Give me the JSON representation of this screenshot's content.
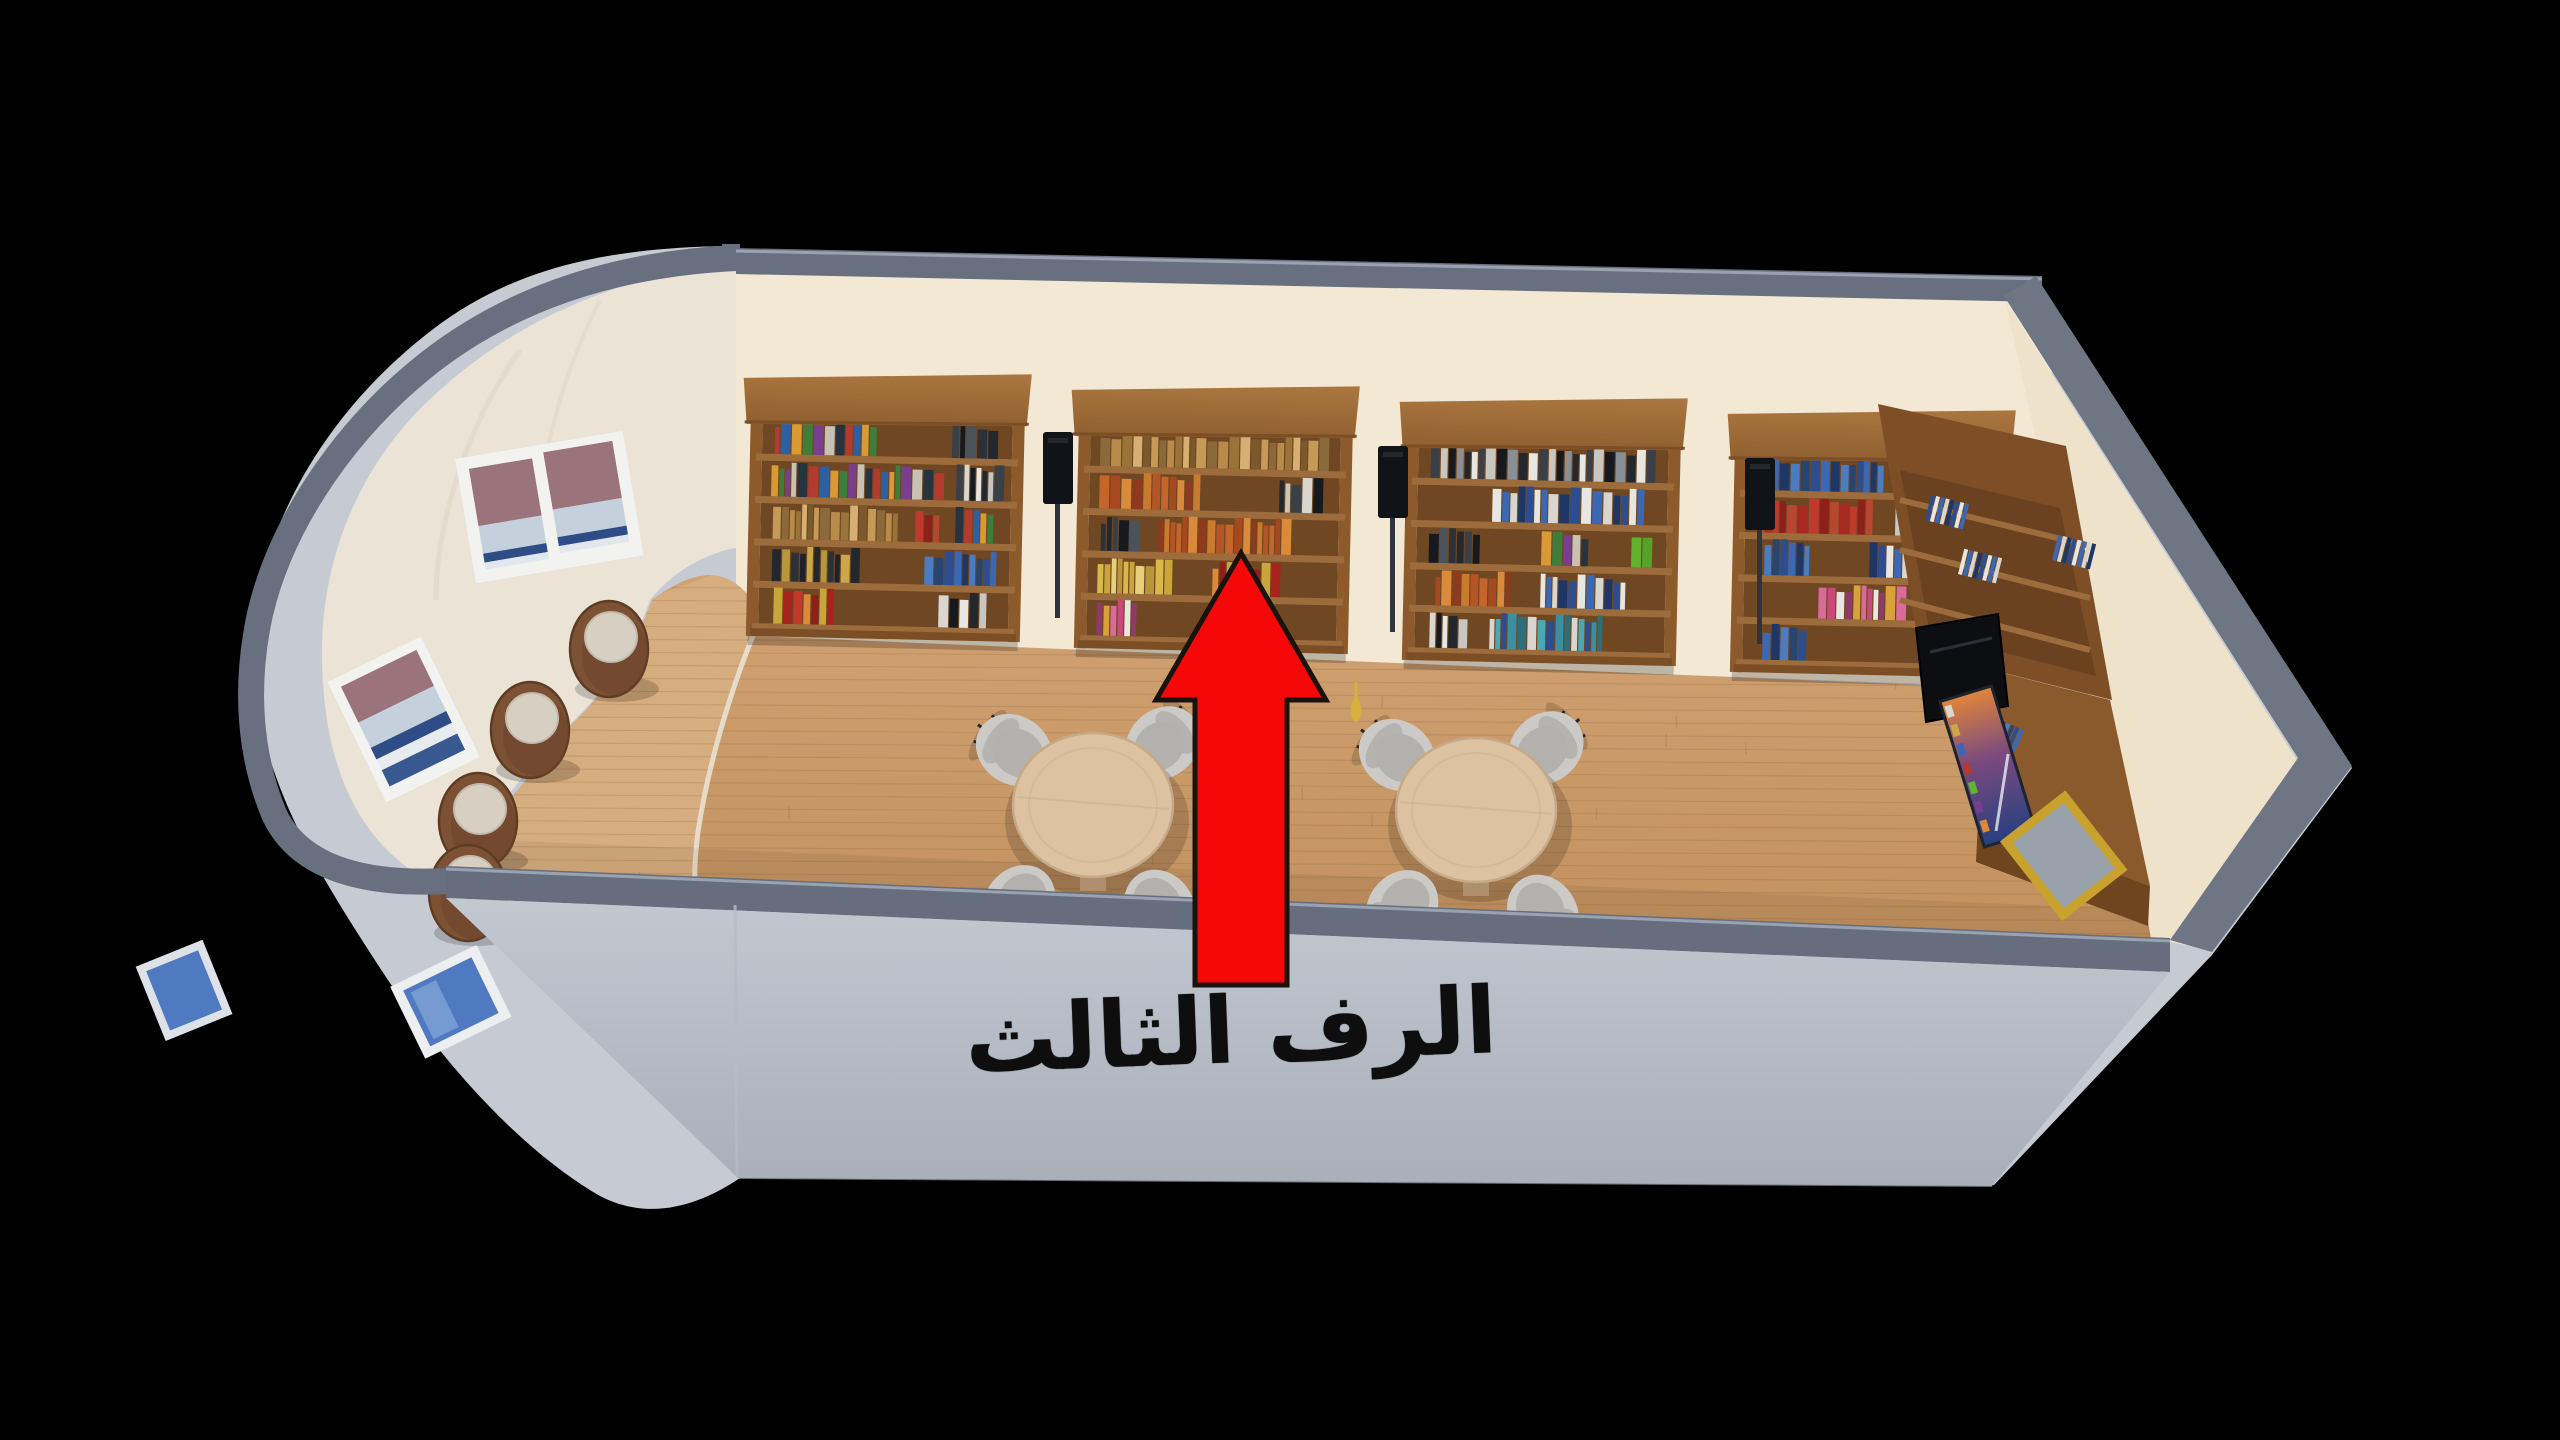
{
  "annotation": {
    "label": "الرف الثالث",
    "meaning": "points to the third shelf of the middle bookcase",
    "text_color": "#0e0e0e",
    "arrow_icon": "up-arrow-icon",
    "arrow_color": "#f70808",
    "arrow_outline": "#1a120c"
  },
  "room": {
    "background": "#000000",
    "wall_top_band": "#68707f",
    "wall_band_lip": "#99a2b0",
    "exterior_wall": "#c6cbd3",
    "front_wall_top": "#c2c8d0",
    "front_wall_bottom": "#a9afb9",
    "back_wall": "#f2e8d4",
    "curved_wall": "#eae3d6",
    "right_wall": "#efe2cb",
    "floor": "#cb9b68",
    "floor_light": "#d6ad7e",
    "floor_line": "#e9e2d4",
    "shelf_wood": "#8c5a2b",
    "shelf_cap": "#a06c38",
    "shelf_interior": "#6f4722",
    "shelf_board": "#9c6c3c",
    "shelf_plinth": "#7b4e26",
    "table_top": "#dcc2a0",
    "table_rim": "#c6a987",
    "table_base": "#b08f6f",
    "chair_shell": "#cbcac6",
    "chair_seat": "#b2b1ad",
    "chair_leg": "#26262a",
    "stool_body": "#7c5134",
    "stool_rim": "#5e3c24",
    "stool_cushion": "#d7cfc2",
    "speaker": "#101317",
    "tv_screen": "#0c0e11",
    "window_frame": "#f2f2f0",
    "glass_blue": "#4f79c0",
    "glass_blue_light": "#7fa3d6",
    "glass_mauve": "#9b737b",
    "glass_sky": "#c5d0dd",
    "glass_navy": "#2e4d86",
    "poster_gold_frame": "#c9a22e",
    "tassel_gold": "#d8b13a"
  },
  "furniture": {
    "bookshelf_units": 4,
    "shelf_rows_per_unit": 5,
    "round_tables": 2,
    "chairs_per_table": 4,
    "barrel_stools": 4,
    "floor_speakers": 3,
    "tv_screens": 1,
    "curved_wall_windows": 2,
    "exterior_windows": 2,
    "right_wall_posters": 2
  },
  "palettes": {
    "multi": [
      "#b23a2e",
      "#2e5fa3",
      "#d99a33",
      "#3f7d3a",
      "#7a3e8f",
      "#c8c2b4",
      "#27333f"
    ],
    "gold": [
      "#b88b4a",
      "#9a7339",
      "#d6b073",
      "#7a5a2c",
      "#c49a56",
      "#8a6a3a"
    ],
    "orange": [
      "#c4662a",
      "#a8481f",
      "#d98a3a",
      "#8f3a1c",
      "#c97a2e",
      "#b55526"
    ],
    "dark": [
      "#23282e",
      "#3a4048",
      "#16191d",
      "#4a525c",
      "#2c3138"
    ],
    "dark_gold": [
      "#1d222b",
      "#caa84a",
      "#23282e",
      "#b8963a",
      "#2c3138"
    ],
    "white": [
      "#e8e6e0",
      "#d9d6cf",
      "#c9c6bf",
      "#efece6"
    ],
    "mono_bw": [
      "#e8e6e0",
      "#23282e",
      "#c9c6bf",
      "#3a4048",
      "#d9d6cf",
      "#16191d"
    ],
    "bw_dense": [
      "#23282e",
      "#e8e6e0",
      "#3a4048",
      "#c9c6bf",
      "#16191d",
      "#8a8f96"
    ],
    "blue": [
      "#2c4d8f",
      "#3a68b5",
      "#1f3766",
      "#4a7cc2",
      "#27456f"
    ],
    "navy_white": [
      "#2c4d8f",
      "#e8e6e0",
      "#3a68b5",
      "#d9d6cf",
      "#1f3766"
    ],
    "red": [
      "#a82922",
      "#c03a2c",
      "#8f1f1a",
      "#b5482e"
    ],
    "red_gold": [
      "#a8231d",
      "#c03a2c",
      "#d98a3a",
      "#8f1f1a",
      "#c9a53a"
    ],
    "pink_multi": [
      "#d96a9a",
      "#c94a7a",
      "#e8e6e0",
      "#8f3a6a",
      "#d9a13a"
    ],
    "yellow": [
      "#d9b84a",
      "#c9a53a",
      "#e8cf7a",
      "#b8963a"
    ],
    "teal_multi": [
      "#3a8fa3",
      "#2c6f7a",
      "#d9d6cf",
      "#4aa8b5",
      "#2c4d8f"
    ],
    "green_solid": [
      "#61b32e",
      "#55a328"
    ]
  },
  "book_segments": [
    [
      0,
      0,
      0.05,
      0.4,
      "multi"
    ],
    [
      0,
      0,
      0.76,
      0.2,
      "dark"
    ],
    [
      0,
      1,
      0.04,
      0.7,
      "multi"
    ],
    [
      0,
      1,
      0.78,
      0.18,
      "mono_bw"
    ],
    [
      0,
      2,
      0.05,
      0.52,
      "gold"
    ],
    [
      0,
      2,
      0.62,
      0.1,
      "red"
    ],
    [
      0,
      2,
      0.78,
      0.16,
      "multi"
    ],
    [
      0,
      3,
      0.05,
      0.34,
      "dark_gold"
    ],
    [
      0,
      3,
      0.66,
      0.3,
      "blue"
    ],
    [
      0,
      4,
      0.06,
      0.24,
      "red_gold"
    ],
    [
      0,
      4,
      0.72,
      0.2,
      "mono_bw"
    ],
    [
      1,
      0,
      0.04,
      0.92,
      "gold"
    ],
    [
      1,
      1,
      0.04,
      0.4,
      "orange"
    ],
    [
      1,
      1,
      0.76,
      0.16,
      "mono_bw"
    ],
    [
      1,
      2,
      0.05,
      0.16,
      "dark"
    ],
    [
      1,
      2,
      0.28,
      0.55,
      "orange"
    ],
    [
      1,
      3,
      0.04,
      0.3,
      "yellow"
    ],
    [
      1,
      3,
      0.5,
      0.28,
      "red_gold"
    ],
    [
      1,
      4,
      0.04,
      0.16,
      "pink_multi"
    ],
    [
      1,
      4,
      0.5,
      0.25,
      "red"
    ],
    [
      2,
      0,
      0.05,
      0.9,
      "bw_dense"
    ],
    [
      2,
      1,
      0.3,
      0.6,
      "navy_white"
    ],
    [
      2,
      2,
      0.05,
      0.22,
      "dark"
    ],
    [
      2,
      2,
      0.5,
      0.2,
      "multi"
    ],
    [
      2,
      2,
      0.86,
      0.09,
      "green_solid"
    ],
    [
      2,
      3,
      0.08,
      0.3,
      "orange"
    ],
    [
      2,
      3,
      0.5,
      0.35,
      "navy_white"
    ],
    [
      2,
      4,
      0.3,
      0.45,
      "teal_multi"
    ],
    [
      2,
      4,
      0.06,
      0.16,
      "mono_bw"
    ],
    [
      3,
      0,
      0.05,
      0.5,
      "blue"
    ],
    [
      3,
      0,
      0.7,
      0.15,
      "white"
    ],
    [
      3,
      1,
      0.05,
      0.45,
      "red"
    ],
    [
      3,
      1,
      0.6,
      0.28,
      "mono_bw"
    ],
    [
      3,
      2,
      0.08,
      0.2,
      "blue"
    ],
    [
      3,
      2,
      0.5,
      0.3,
      "navy_white"
    ],
    [
      3,
      3,
      0.3,
      0.35,
      "pink_multi"
    ],
    [
      3,
      4,
      0.08,
      0.18,
      "blue"
    ]
  ]
}
